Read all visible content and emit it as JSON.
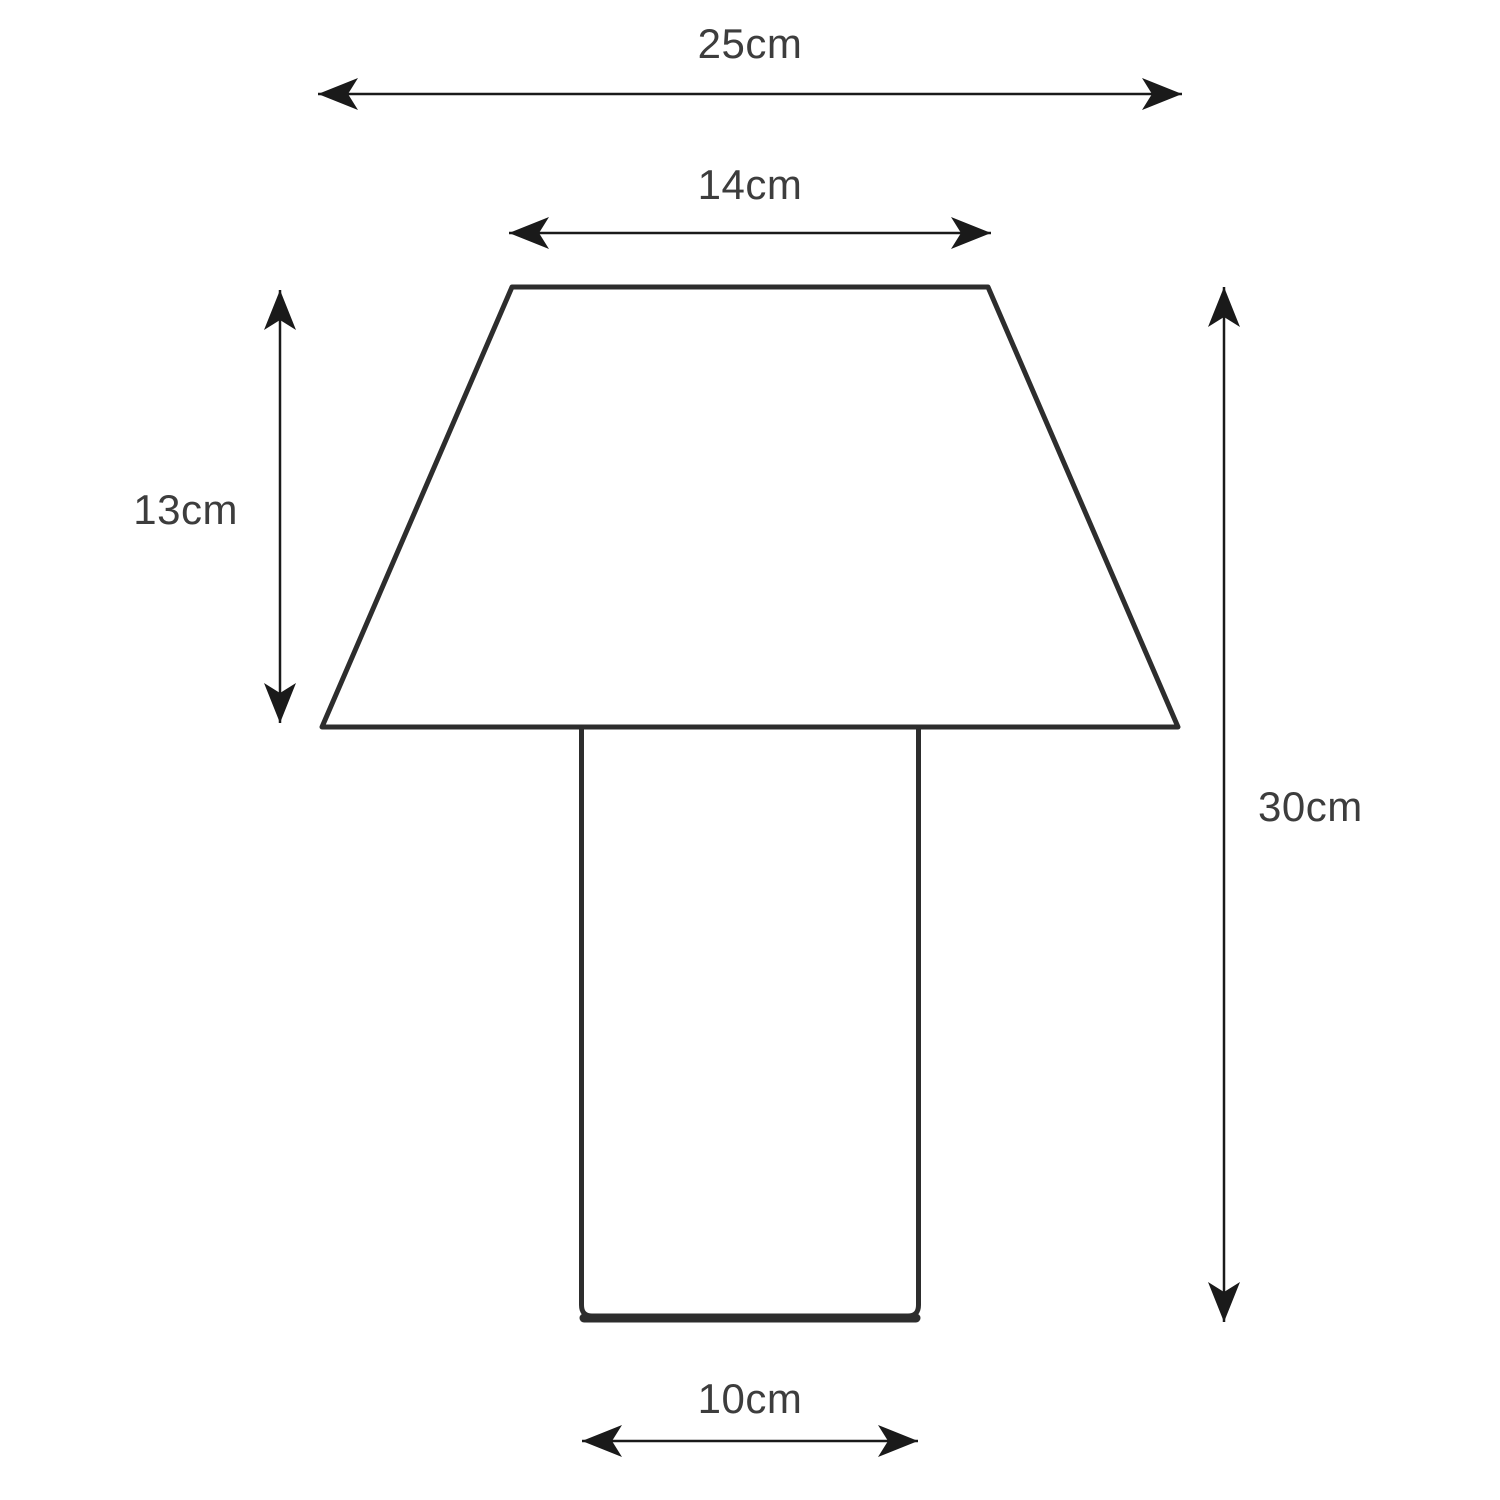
{
  "diagram": {
    "title": "table-lamp-dimension-diagram",
    "subject": "table lamp (trapezoid shade on cylindrical base), front elevation line drawing",
    "background_color": "#ffffff",
    "outline_color": "#2d2d2d",
    "dimension_line_color": "#1a1a1a",
    "label_text_color": "#3d3d3d",
    "dimensions": {
      "overall_width": {
        "label": "25cm",
        "value": 25,
        "unit": "cm",
        "measures": "shade bottom / overall width"
      },
      "shade_top_width": {
        "label": "14cm",
        "value": 14,
        "unit": "cm",
        "measures": "shade top width"
      },
      "shade_height": {
        "label": "13cm",
        "value": 13,
        "unit": "cm",
        "measures": "shade height"
      },
      "overall_height": {
        "label": "30cm",
        "value": 30,
        "unit": "cm",
        "measures": "overall lamp height"
      },
      "base_width": {
        "label": "10cm",
        "value": 10,
        "unit": "cm",
        "measures": "base diameter/width"
      }
    }
  }
}
